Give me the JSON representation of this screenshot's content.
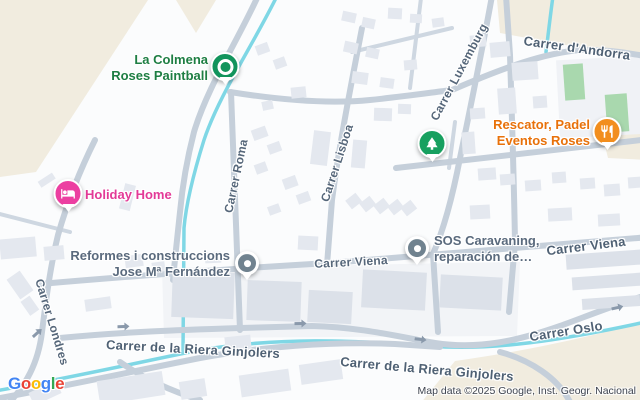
{
  "map": {
    "attribution": "Map data ©2025 Google, Inst. Geogr. Nacional",
    "logo": {
      "text": "Google",
      "letter_colors": [
        "#4285F4",
        "#EA4335",
        "#FBBC05",
        "#4285F4",
        "#34A853",
        "#EA4335"
      ]
    },
    "colors": {
      "land": "#fbfcfd",
      "terrain_beige": "#f1ecdf",
      "water_cyan": "#7fd7e5",
      "road": "#c5cfda",
      "road_minor": "#ced7e1",
      "building": "#e4e8ef",
      "building_industrial": "#dce1e9",
      "sports_court_green": "#a9d8ae",
      "street_text": "#56677a",
      "arrow": "#8a99ab"
    },
    "street_labels": [
      {
        "label": "Carrer d'Andorra",
        "x": 577,
        "y": 48,
        "rotate": 8,
        "major": true
      },
      {
        "label": "Carrer Luxemburg",
        "x": 459,
        "y": 72,
        "rotate": -62,
        "major": false
      },
      {
        "label": "Carrer Lisboa",
        "x": 337,
        "y": 163,
        "rotate": -72,
        "major": false
      },
      {
        "label": "Carrer Roma",
        "x": 236,
        "y": 176,
        "rotate": -78,
        "major": false
      },
      {
        "label": "Carrer Londres",
        "x": 52,
        "y": 322,
        "rotate": 73,
        "major": false
      },
      {
        "label": "Carrer Viena",
        "x": 351,
        "y": 262,
        "rotate": -3,
        "major": false
      },
      {
        "label": "Carrer Viena",
        "x": 586,
        "y": 246,
        "rotate": -7,
        "major": true
      },
      {
        "label": "Carrer Oslo",
        "x": 566,
        "y": 331,
        "rotate": -9,
        "major": true
      },
      {
        "label": "Carrer de la Riera Ginjolers",
        "x": 193,
        "y": 349,
        "rotate": 3,
        "major": true
      },
      {
        "label": "Carrer de la Riera Ginjolers",
        "x": 427,
        "y": 369,
        "rotate": 5,
        "major": true
      }
    ],
    "pois": [
      {
        "id": "la-colmena-roses-paintball",
        "lines": [
          "La Colmena",
          "Roses Paintball"
        ],
        "label_side": "left",
        "label_color": "#1e7e43",
        "marker": {
          "style": "pin",
          "color": "#12945c",
          "icon": "paintball-icon"
        },
        "x": 225,
        "y": 70
      },
      {
        "id": "holiday-home",
        "lines": [
          "Holiday Home"
        ],
        "label_side": "right",
        "label_color": "#e33a97",
        "marker": {
          "style": "pin",
          "color": "#ec3fa1",
          "icon": "bed-icon"
        },
        "x": 68,
        "y": 197
      },
      {
        "id": "park",
        "lines": [],
        "label_side": "right",
        "label_color": "#1e7e43",
        "marker": {
          "style": "pin",
          "color": "#17a05f",
          "icon": "tree-icon"
        },
        "x": 432,
        "y": 147
      },
      {
        "id": "rescator-padel-eventos-roses",
        "lines": [
          "Rescator, Padel",
          "Eventos Roses"
        ],
        "label_side": "left",
        "label_color": "#e8710a",
        "marker": {
          "style": "pin",
          "color": "#f28e1e",
          "icon": "restaurant-icon"
        },
        "x": 607,
        "y": 135
      },
      {
        "id": "reformes-i-construccions-jose-m-fernandez",
        "lines": [
          "Reformes i construccions",
          "Jose Mª Fernández"
        ],
        "label_side": "left",
        "label_color": "#5a6a7d",
        "marker": {
          "style": "dot",
          "color": "#70828f"
        },
        "x": 247,
        "y": 266
      },
      {
        "id": "sos-caravaning",
        "lines": [
          "SOS Caravaning,",
          "reparación de…"
        ],
        "label_side": "right",
        "label_color": "#5a6a7d",
        "marker": {
          "style": "dot",
          "color": "#70828f"
        },
        "x": 417,
        "y": 251
      }
    ],
    "one_way_arrows": [
      {
        "x": 124,
        "y": 327,
        "rotate": -2
      },
      {
        "x": 301,
        "y": 324,
        "rotate": -1
      },
      {
        "x": 421,
        "y": 340,
        "rotate": 7
      },
      {
        "x": 618,
        "y": 308,
        "rotate": -13
      },
      {
        "x": 38,
        "y": 333,
        "rotate": -42
      }
    ]
  }
}
